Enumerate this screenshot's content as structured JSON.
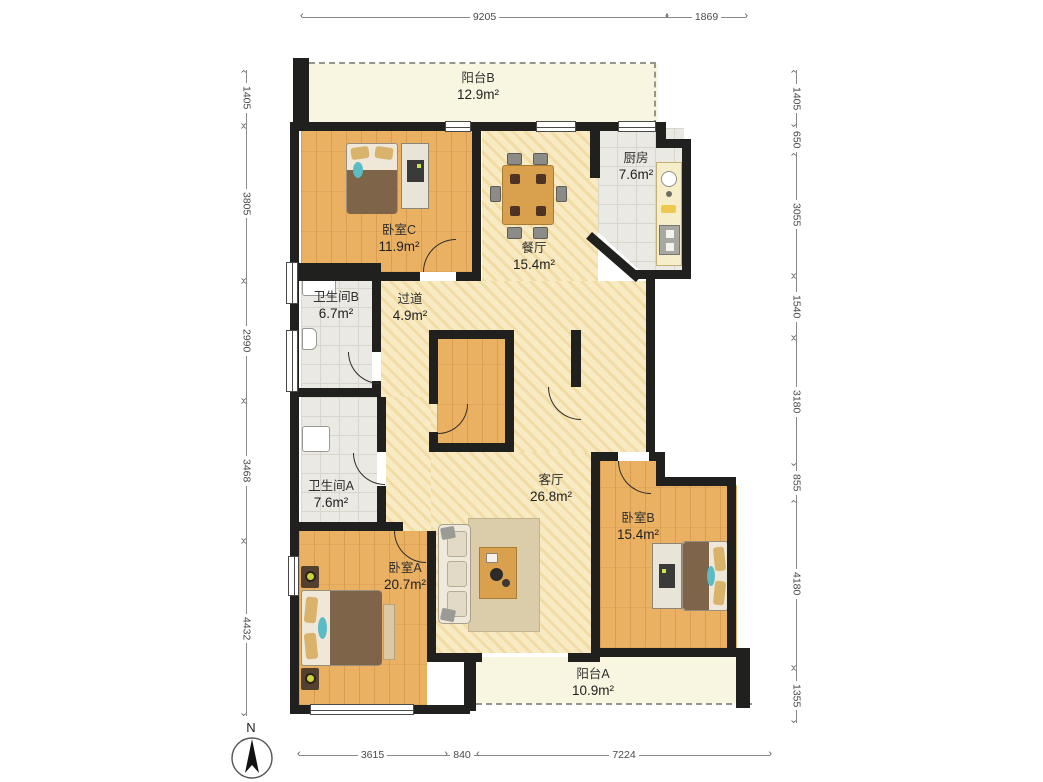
{
  "compass": {
    "label": "N"
  },
  "rooms": {
    "balcony_b": {
      "name": "阳台B",
      "area": "12.9m²"
    },
    "bedroom_c": {
      "name": "卧室C",
      "area": "11.9m²"
    },
    "dining": {
      "name": "餐厅",
      "area": "15.4m²"
    },
    "kitchen": {
      "name": "厨房",
      "area": "7.6m²"
    },
    "bath_b": {
      "name": "卫生间B",
      "area": "6.7m²"
    },
    "hallway": {
      "name": "过道",
      "area": "4.9m²"
    },
    "bath_a": {
      "name": "卫生间A",
      "area": "7.6m²"
    },
    "living": {
      "name": "客厅",
      "area": "26.8m²"
    },
    "bedroom_b": {
      "name": "卧室B",
      "area": "15.4m²"
    },
    "bedroom_a": {
      "name": "卧室A",
      "area": "20.7m²"
    },
    "balcony_a": {
      "name": "阳台A",
      "area": "10.9m²"
    }
  },
  "dimensions": {
    "top": [
      "9205",
      "1869"
    ],
    "left": [
      "1405",
      "3805",
      "2990",
      "3468",
      "4432"
    ],
    "right": [
      "1405",
      "650",
      "3055",
      "1540",
      "3180",
      "855",
      "4180",
      "1355"
    ],
    "bottom": [
      "3615",
      "840",
      "7224"
    ]
  },
  "colors": {
    "wall": "#20201e",
    "wood_floor": "#eab163",
    "tile_floor": "#ebe9e3",
    "warm_floor": "#f7e8bc",
    "balcony_floor": "#f8f6e0",
    "accent_teal": "#5bbcc4"
  }
}
